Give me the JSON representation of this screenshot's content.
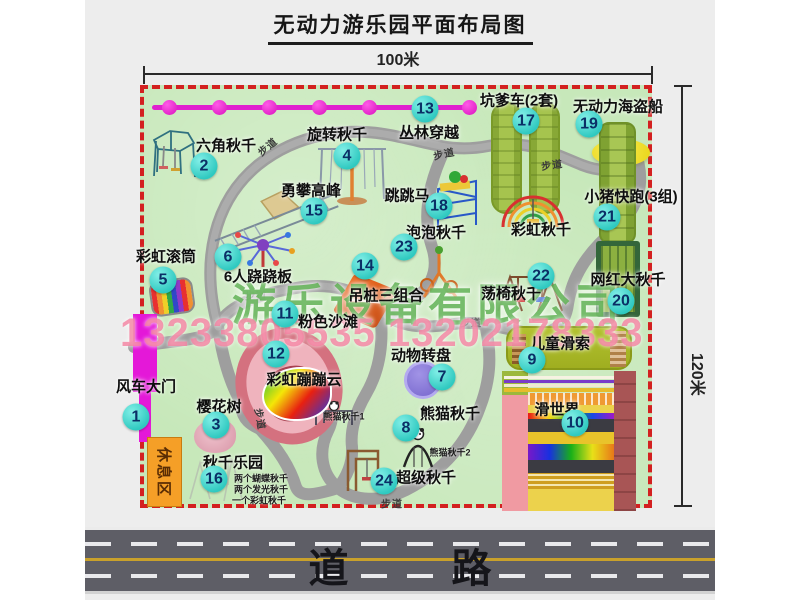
{
  "page": {
    "title": "无动力游乐园平面布局图"
  },
  "dimensions": {
    "width": "100米",
    "height": "120米"
  },
  "road": {
    "label": "道 路"
  },
  "watermark": {
    "company": "游乐设备有限公司",
    "phone": "13233805535 13202178333"
  },
  "rest_area": {
    "label": "休息区"
  },
  "walkway": {
    "label": "步道",
    "positions": [
      {
        "x": 123,
        "y": 57,
        "r": -40
      },
      {
        "x": 300,
        "y": 64,
        "r": -12
      },
      {
        "x": 408,
        "y": 75,
        "r": -8
      },
      {
        "x": 112,
        "y": 206,
        "r": 0
      },
      {
        "x": 327,
        "y": 233,
        "r": 0
      },
      {
        "x": 117,
        "y": 330,
        "r": 80
      },
      {
        "x": 248,
        "y": 414,
        "r": 0
      }
    ]
  },
  "chain": {
    "dot_positions": [
      17,
      67,
      117,
      167,
      217,
      267,
      317
    ]
  },
  "colors": {
    "border": "#d32020",
    "marker": "#3fd9cf",
    "chain": "#e020cf",
    "map_green": "#c7e8ba",
    "road_line": "#c9a12b"
  },
  "pois": [
    {
      "num": "1",
      "label": "风车大门",
      "lx": 2,
      "ly": 297,
      "nx": -8,
      "ny": 328
    },
    {
      "num": "2",
      "label": "六角秋千",
      "lx": 82,
      "ly": 56,
      "nx": 60,
      "ny": 77
    },
    {
      "num": "3",
      "label": "樱花树",
      "lx": 75,
      "ly": 317,
      "nx": 72,
      "ny": 336
    },
    {
      "num": "4",
      "label": "旋转秋千",
      "lx": 193,
      "ly": 45,
      "nx": 203,
      "ny": 67
    },
    {
      "num": "5",
      "label": "彩虹滚筒",
      "lx": 22,
      "ly": 167,
      "nx": 19,
      "ny": 191
    },
    {
      "num": "6",
      "label": "6人跷跷板",
      "lx": 114,
      "ly": 187,
      "nx": 84,
      "ny": 168
    },
    {
      "num": "7",
      "label": "动物转盘",
      "lx": 277,
      "ly": 266,
      "nx": 298,
      "ny": 288
    },
    {
      "num": "8",
      "label": "熊猫秋千",
      "lx": 306,
      "ly": 324,
      "nx": 262,
      "ny": 339,
      "subs": [
        {
          "text": "熊猫秋千1",
          "x": 200,
          "y": 327
        },
        {
          "text": "熊猫秋千2",
          "x": 306,
          "y": 363
        }
      ]
    },
    {
      "num": "9",
      "label": "儿童滑索",
      "lx": 416,
      "ly": 254,
      "nx": 388,
      "ny": 271
    },
    {
      "num": "10",
      "label": "滑世界",
      "lx": 413,
      "ly": 320,
      "nx": 431,
      "ny": 334
    },
    {
      "num": "11",
      "label": "粉色沙滩",
      "lx": 184,
      "ly": 232,
      "nx": 141,
      "ny": 225
    },
    {
      "num": "12",
      "label": "彩虹蹦蹦云",
      "lx": 160,
      "ly": 290,
      "nx": 132,
      "ny": 265
    },
    {
      "num": "13",
      "label": "丛林穿越",
      "lx": 285,
      "ly": 43,
      "nx": 281,
      "ny": 20
    },
    {
      "num": "14",
      "label": "吊桩三组合",
      "lx": 242,
      "ly": 206,
      "nx": 221,
      "ny": 177
    },
    {
      "num": "15",
      "label": "勇攀高峰",
      "lx": 167,
      "ly": 101,
      "nx": 170,
      "ny": 122
    },
    {
      "num": "16",
      "label": "秋千乐园",
      "lx": 89,
      "ly": 373,
      "nx": 70,
      "ny": 390,
      "subs": [
        {
          "text": "两个蝴蝶秋千",
          "x": 117,
          "y": 389
        },
        {
          "text": "两个发光秋千",
          "x": 117,
          "y": 400
        },
        {
          "text": "一个彩虹秋千",
          "x": 115,
          "y": 411
        }
      ]
    },
    {
      "num": "17",
      "label": "坑爹车(2套)",
      "lx": 375,
      "ly": 11,
      "nx": 382,
      "ny": 32
    },
    {
      "num": "18",
      "label": "跳跳马",
      "lx": 263,
      "ly": 106,
      "nx": 295,
      "ny": 117
    },
    {
      "num": "19",
      "label": "无动力海盗船",
      "lx": 474,
      "ly": 17,
      "nx": 445,
      "ny": 35
    },
    {
      "num": "20",
      "label": "网红大秋千",
      "lx": 484,
      "ly": 190,
      "nx": 477,
      "ny": 212
    },
    {
      "num": "21",
      "label": "小猪快跑(3组)",
      "lx": 487,
      "ly": 107,
      "nx": 463,
      "ny": 128
    },
    {
      "num": "22",
      "label": "荡椅秋千",
      "lx": 367,
      "ly": 204,
      "nx": 397,
      "ny": 187
    },
    {
      "num": "23",
      "label": "泡泡秋千",
      "lx": 292,
      "ly": 143,
      "nx": 260,
      "ny": 158
    },
    {
      "num": "24",
      "label": "超级秋千",
      "lx": 282,
      "ly": 388,
      "nx": 240,
      "ny": 392
    },
    {
      "num": "",
      "label": "彩虹秋千",
      "lx": 397,
      "ly": 140,
      "nx": 0,
      "ny": 0
    }
  ]
}
